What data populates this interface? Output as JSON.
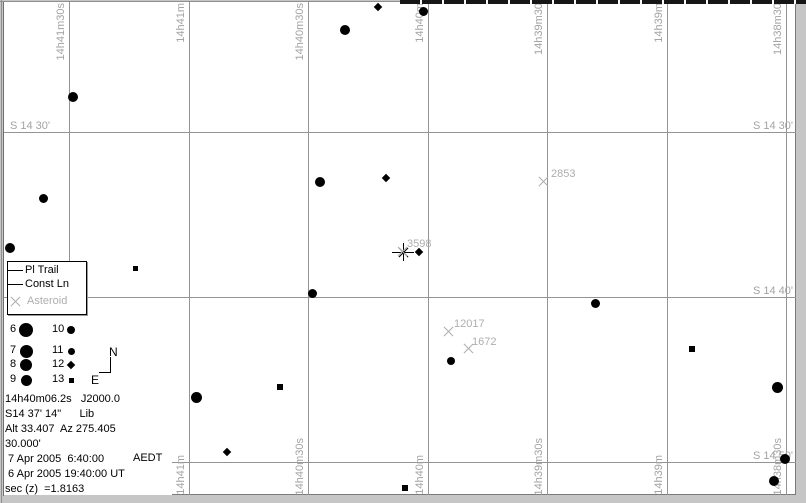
{
  "colors": {
    "grid": "#949494",
    "axis_label": "#a3a3a3",
    "asteroid": "#aeaeae",
    "star": "#000000",
    "chart_background": "#ffffff",
    "window_frame": "#c6c6c6"
  },
  "sky": {
    "ra_lines": [
      {
        "x": 69,
        "top_label": "14h41m30s",
        "bottom_label": ""
      },
      {
        "x": 189,
        "top_label": "14h41m",
        "bottom_label": "14h41m"
      },
      {
        "x": 308,
        "top_label": "14h40m30s",
        "bottom_label": "14h40m30s"
      },
      {
        "x": 428,
        "top_label": "14h40m",
        "bottom_label": "14h40m"
      },
      {
        "x": 547,
        "top_label": "14h39m30",
        "bottom_label": "14h39m30s"
      },
      {
        "x": 667,
        "top_label": "14h39m",
        "bottom_label": "14h39m"
      },
      {
        "x": 786,
        "top_label": "14h38m30",
        "bottom_label": "14h38m30s"
      }
    ],
    "dec_lines": [
      {
        "y": 132,
        "left_label": "S 14 30'",
        "right_label": "S 14 30'"
      },
      {
        "y": 297,
        "left_label": "",
        "right_label": "S 14 40'"
      },
      {
        "y": 462,
        "left_label": "",
        "right_label": "S 14 50'"
      }
    ],
    "stars": [
      {
        "x": 73,
        "y": 97,
        "size": 10,
        "shape": "circle"
      },
      {
        "x": 43,
        "y": 198,
        "size": 9,
        "shape": "circle"
      },
      {
        "x": 10,
        "y": 248,
        "size": 10,
        "shape": "circle"
      },
      {
        "x": 135,
        "y": 268,
        "size": 5,
        "shape": "square"
      },
      {
        "x": 345,
        "y": 30,
        "size": 10,
        "shape": "circle"
      },
      {
        "x": 378,
        "y": 7,
        "size": 8,
        "shape": "diamond"
      },
      {
        "x": 423,
        "y": 11,
        "size": 9,
        "shape": "circle"
      },
      {
        "x": 320,
        "y": 182,
        "size": 10,
        "shape": "circle"
      },
      {
        "x": 386,
        "y": 178,
        "size": 8,
        "shape": "diamond"
      },
      {
        "x": 419,
        "y": 252,
        "size": 8,
        "shape": "diamond"
      },
      {
        "x": 312,
        "y": 293,
        "size": 9,
        "shape": "circle"
      },
      {
        "x": 595,
        "y": 303,
        "size": 9,
        "shape": "circle"
      },
      {
        "x": 451,
        "y": 361,
        "size": 8,
        "shape": "circle"
      },
      {
        "x": 196,
        "y": 397,
        "size": 11,
        "shape": "circle"
      },
      {
        "x": 280,
        "y": 387,
        "size": 6,
        "shape": "square"
      },
      {
        "x": 227,
        "y": 452,
        "size": 8,
        "shape": "diamond"
      },
      {
        "x": 405,
        "y": 488,
        "size": 6,
        "shape": "square"
      },
      {
        "x": 692,
        "y": 349,
        "size": 6,
        "shape": "square"
      },
      {
        "x": 777,
        "y": 387,
        "size": 11,
        "shape": "circle"
      },
      {
        "x": 785,
        "y": 459,
        "size": 10,
        "shape": "circle"
      },
      {
        "x": 774,
        "y": 481,
        "size": 10,
        "shape": "circle"
      }
    ],
    "asteroids": [
      {
        "number": "2853",
        "x": 544,
        "y": 182,
        "label_x": 551,
        "label_y": 168,
        "selected": false
      },
      {
        "number": "3598",
        "x": 403,
        "y": 252,
        "label_x": 407,
        "label_y": 238,
        "selected": true
      },
      {
        "number": "12017",
        "x": 449,
        "y": 332,
        "label_x": 454,
        "label_y": 318,
        "selected": false
      },
      {
        "number": "1672",
        "x": 469,
        "y": 349,
        "label_x": 472,
        "label_y": 336,
        "selected": false
      }
    ]
  },
  "legend": {
    "items": [
      {
        "symbol": "line",
        "label": "Pl Trail"
      },
      {
        "symbol": "line",
        "label": "Const Ln"
      },
      {
        "symbol": "x",
        "label": "Asteroid"
      }
    ]
  },
  "magnitude_scale": {
    "rows": [
      {
        "y": 330,
        "left_mag": "6",
        "left_size": 14,
        "right_mag": "10",
        "right_size": 8,
        "right_shape": "circle"
      },
      {
        "y": 351,
        "left_mag": "7",
        "left_size": 13,
        "right_mag": "11",
        "right_size": 7,
        "right_shape": "circle"
      },
      {
        "y": 365,
        "left_mag": "8",
        "left_size": 12,
        "right_mag": "12",
        "right_size": 7,
        "right_shape": "diamond"
      },
      {
        "y": 380,
        "left_mag": "9",
        "left_size": 11,
        "right_mag": "13",
        "right_size": 5,
        "right_shape": "square"
      }
    ]
  },
  "compass": {
    "north": "N",
    "east": "E"
  },
  "status": {
    "lines": [
      "14h40m06.2s   J2000.0",
      "S14 37' 14\"      Lib",
      "Alt 33.407  Az 275.405",
      "30.000'",
      " 7 Apr 2005  6:40:00",
      " 6 Apr 2005 19:40:00 UT",
      "sec (z)  =1.8163"
    ],
    "timezone": "AEDT"
  }
}
